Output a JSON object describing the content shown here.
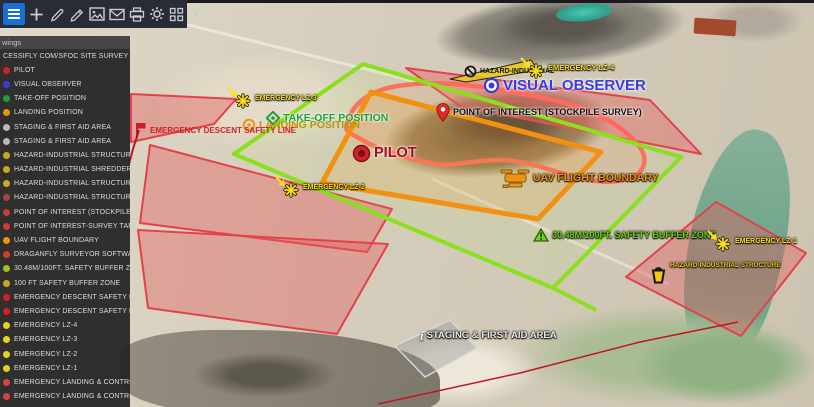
{
  "toolbar": {
    "background": "#272c35",
    "active_color": "#1670d8",
    "buttons": [
      {
        "id": "menu",
        "active": true
      },
      {
        "id": "add"
      },
      {
        "id": "draw"
      },
      {
        "id": "measure"
      },
      {
        "id": "image"
      },
      {
        "id": "mail"
      },
      {
        "id": "print"
      },
      {
        "id": "settings"
      },
      {
        "id": "apps"
      },
      {
        "id": "collapse"
      }
    ]
  },
  "sidebar": {
    "header": "wings",
    "items": [
      {
        "label": "CESSIFLY COM/SFOC SITE SURVEY",
        "icon": null
      },
      {
        "label": "PILOT",
        "icon": "#d2202e"
      },
      {
        "label": "VISUAL OBSERVER",
        "icon": "#3a3ae0"
      },
      {
        "label": "TAKE-OFF POSITION",
        "icon": "#1ca03e"
      },
      {
        "label": "LANDING POSITION",
        "icon": "#e89414"
      },
      {
        "label": "STAGING & FIRST AID AREA",
        "icon": "#b9b9b9"
      },
      {
        "label": "STAGING & FIRST AID AREA",
        "icon": "#b9b9b9"
      },
      {
        "label": "HAZARD-INDUSTRIAL STRUCTURE",
        "icon": "#caa91c"
      },
      {
        "label": "HAZARD-INDUSTRIAL SHREDDER",
        "icon": "#caa91c"
      },
      {
        "label": "HAZARD-INDUSTRIAL STRUCTURE",
        "icon": "#caa91c"
      },
      {
        "label": "HAZARD-INDUSTRIAL STRUCTURE",
        "icon": "#b04040"
      },
      {
        "label": "POINT OF INTEREST (STOCKPILE SURVEY)",
        "icon": "#d43838"
      },
      {
        "label": "POINT OF INTEREST-SURVEY TARGET",
        "icon": "#d43838"
      },
      {
        "label": "UAV FLIGHT BOUNDARY",
        "icon": "#ef9410"
      },
      {
        "label": "DRAGANFLY SURVEYOR SOFTWARE UAV FLIGHT",
        "icon": "#d43838"
      },
      {
        "label": "30.48M/100FT. SAFETY BUFFER ZONE",
        "icon": "#9ec41a"
      },
      {
        "label": "100 FT SAFETY BUFFER ZONE",
        "icon": "#caa91c"
      },
      {
        "label": "EMERGENCY DESCENT SAFETY LINE",
        "icon": "#d42222"
      },
      {
        "label": "EMERGENCY DESCENT SAFETY LINE",
        "icon": "#d42222"
      },
      {
        "label": "EMERGENCY LZ-4",
        "icon": "#e8d020"
      },
      {
        "label": "EMERGENCY LZ-3",
        "icon": "#e8d020"
      },
      {
        "label": "EMERGENCY LZ-2",
        "icon": "#e8d020"
      },
      {
        "label": "EMERGENCY LZ-1",
        "icon": "#e8d020"
      },
      {
        "label": "EMERGENCY LANDING & CONTROLLED DESCENT",
        "icon": "#d44444"
      },
      {
        "label": "EMERGENCY LANDING & CONTROLLED DESCENT",
        "icon": "#d44444"
      }
    ]
  },
  "map": {
    "markers": [
      {
        "id": "hazard-industrial-top",
        "icon": "noentry",
        "icon_color": "#141414",
        "label": "HAZARD-INDUSTRIAL",
        "x": 464,
        "y": 65,
        "label_color": "#141405",
        "fs": 7,
        "halo": "none"
      },
      {
        "id": "emergency-lz-4",
        "icon": "lz",
        "icon_color": "#ffdf1c",
        "label": "EMERGENCY LZ-4",
        "x": 519,
        "y": 56,
        "label_color": "#ffdf1c",
        "fs": 7.5,
        "halo": "dark"
      },
      {
        "id": "visual-observer",
        "icon": "eye",
        "icon_color": "#3a3ae0",
        "label": "VISUAL OBSERVER",
        "x": 483,
        "y": 77,
        "label_color": "#3a3ae0",
        "fs": 15,
        "halo": "light"
      },
      {
        "id": "point-of-interest",
        "icon": "pin",
        "icon_color": "#e02828",
        "label": "POINT OF INTEREST (STOCKPILE SURVEY)",
        "x": 436,
        "y": 103,
        "label_color": "#101010",
        "fs": 9,
        "halo": "light"
      },
      {
        "id": "emergency-lz-3",
        "icon": "lz",
        "icon_color": "#ffdf1c",
        "label": "EMERGENCY LZ-3",
        "x": 226,
        "y": 86,
        "label_color": "#ffdf1c",
        "fs": 7,
        "halo": "dark"
      },
      {
        "id": "take-off-position",
        "icon": "diamond",
        "icon_color": "#1ca03e",
        "label": "TAKE-OFF POSITION",
        "x": 266,
        "y": 111,
        "label_color": "#17a437",
        "fs": 10.5,
        "halo": "light"
      },
      {
        "id": "landing-position",
        "icon": "ring",
        "icon_color": "#e89414",
        "label": "LANDING POSITION",
        "x": 242,
        "y": 118,
        "label_color": "#b8980f",
        "fs": 10.5,
        "halo": "none"
      },
      {
        "id": "emergency-descent-safety-line",
        "icon": "flag",
        "icon_color": "#d01828",
        "label": "EMERGENCY DESCENT SAFETY LINE",
        "x": 135,
        "y": 122,
        "label_color": "#d42222",
        "fs": 8,
        "halo": "none"
      },
      {
        "id": "pilot",
        "icon": "pilot",
        "icon_color": "#d2202e",
        "label": "PILOT",
        "x": 352,
        "y": 144,
        "label_color": "#9e1020",
        "fs": 14.5,
        "halo": "light"
      },
      {
        "id": "uav-flight-boundary",
        "icon": "drone",
        "icon_color": "#ef9410",
        "label": "UAV FLIGHT BOUNDARY",
        "x": 500,
        "y": 165,
        "label_color": "#ef9410",
        "fs": 10.5,
        "halo": "dark"
      },
      {
        "id": "emergency-lz-2",
        "icon": "lz",
        "icon_color": "#ffdf1c",
        "label": "EMERGENCY LZ-2",
        "x": 274,
        "y": 175,
        "label_color": "#ffdf1c",
        "fs": 7,
        "halo": "dark"
      },
      {
        "id": "safety-buffer-zone",
        "icon": "tri",
        "icon_color": "#6fd41c",
        "label": "30.48M/100FT. SAFETY BUFFER ZONE",
        "x": 533,
        "y": 228,
        "label_color": "#66d414",
        "fs": 9,
        "halo": "dark"
      },
      {
        "id": "emergency-lz-1",
        "icon": "lz",
        "icon_color": "#ffdf1c",
        "label": "EMERGENCY LZ-1",
        "x": 706,
        "y": 229,
        "label_color": "#ffdf1c",
        "fs": 7,
        "halo": "dark"
      },
      {
        "id": "hazard-industrial-structure",
        "icon": "bin",
        "icon_color": "#f2c811",
        "label": "HAZARD-INDUSTRIAL STRUCTURE",
        "x": 650,
        "y": 263,
        "label_color": "#e8cc14",
        "fs": 6.5,
        "halo": "dark",
        "align": "top"
      },
      {
        "id": "staging-first-aid-area",
        "icon": "info",
        "icon_color": "#f0f0f0",
        "label": "STAGING & FIRST AID AREA",
        "x": 420,
        "y": 329,
        "label_color": "#ececec",
        "fs": 9.5,
        "halo": "dark"
      }
    ],
    "overlays": [
      {
        "id": "hazard-zone-top",
        "points": [
          [
            406,
            68
          ],
          [
            650,
            100
          ],
          [
            701,
            154
          ],
          [
            460,
            106
          ]
        ],
        "stroke": "#e4414b",
        "fill": "rgba(226,92,92,0.42)",
        "w": 2
      },
      {
        "id": "hazard-zone-left",
        "points": [
          [
            150,
            145
          ],
          [
            392,
            209
          ],
          [
            367,
            252
          ],
          [
            140,
            223
          ]
        ],
        "stroke": "#e4414b",
        "fill": "rgba(226,92,92,0.42)",
        "w": 2
      },
      {
        "id": "hazard-zone-bottom-left",
        "points": [
          [
            138,
            230
          ],
          [
            388,
            244
          ],
          [
            337,
            334
          ],
          [
            148,
            308
          ]
        ],
        "stroke": "#e4414b",
        "fill": "rgba(226,92,92,0.40)",
        "w": 2
      },
      {
        "id": "hazard-zone-right",
        "points": [
          [
            716,
            202
          ],
          [
            806,
            253
          ],
          [
            741,
            336
          ],
          [
            626,
            277
          ]
        ],
        "stroke": "#e4414b",
        "fill": "rgba(226,92,92,0.42)",
        "w": 2
      },
      {
        "id": "hazard-zone-top-left",
        "points": [
          [
            131,
            94
          ],
          [
            236,
            99
          ],
          [
            214,
            124
          ],
          [
            131,
            142
          ]
        ],
        "stroke": "#e4414b",
        "fill": "rgba(226,92,92,0.42)",
        "w": 2
      },
      {
        "id": "stockpile-outline",
        "d": "M347,124 C352,102 372,90 398,86 C450,78 505,90 553,100 C590,108 622,124 639,146 C648,158 646,172 630,178 C610,186 583,180 558,172 C538,166 520,160 498,160 C472,160 452,168 430,163 C405,158 380,150 364,141 C350,133 344,132 347,124 Z",
        "stroke": "#ff6a5e",
        "fill": "rgba(255,120,110,0.15)",
        "w": 4.5
      },
      {
        "id": "safety-buffer-zone-outline",
        "points": [
          [
            363,
            64
          ],
          [
            681,
            157
          ],
          [
            553,
            288
          ],
          [
            234,
            154
          ]
        ],
        "stroke": "#8ae01c",
        "fill": "rgba(170,235,80,0.08)",
        "w": 4
      },
      {
        "id": "safety-buffer-tail",
        "type": "polyline",
        "points": [
          [
            553,
            288
          ],
          [
            596,
            310
          ]
        ],
        "stroke": "#8ae01c",
        "w": 4
      },
      {
        "id": "uav-flight-boundary-outline",
        "points": [
          [
            371,
            92
          ],
          [
            601,
            152
          ],
          [
            538,
            219
          ],
          [
            322,
            183
          ]
        ],
        "stroke": "#f29111",
        "fill": "rgba(242,150,30,0.15)",
        "w": 5
      },
      {
        "id": "hazard-marker-wedge",
        "points": [
          [
            450,
            79
          ],
          [
            531,
            60
          ],
          [
            538,
            70
          ],
          [
            466,
            82
          ]
        ],
        "stroke": "#23230f",
        "fill": "rgba(232,200,28,0.85)",
        "w": 1
      },
      {
        "id": "staging-area-outline",
        "points": [
          [
            450,
            320
          ],
          [
            477,
            348
          ],
          [
            425,
            377
          ],
          [
            395,
            346
          ]
        ],
        "stroke": "#d9d9d9",
        "fill": "rgba(150,150,155,0.40)",
        "w": 1.5
      },
      {
        "id": "descent-line-west",
        "type": "polyline",
        "points": [
          [
            139,
            130
          ],
          [
            133,
            149
          ],
          [
            129,
            164
          ]
        ],
        "stroke": "#c01525",
        "w": 2
      },
      {
        "id": "descent-line-south",
        "type": "polyline",
        "points": [
          [
            378,
            404
          ],
          [
            520,
            373
          ],
          [
            640,
            342
          ],
          [
            738,
            322
          ]
        ],
        "stroke": "#c01525",
        "w": 1.5
      }
    ]
  }
}
